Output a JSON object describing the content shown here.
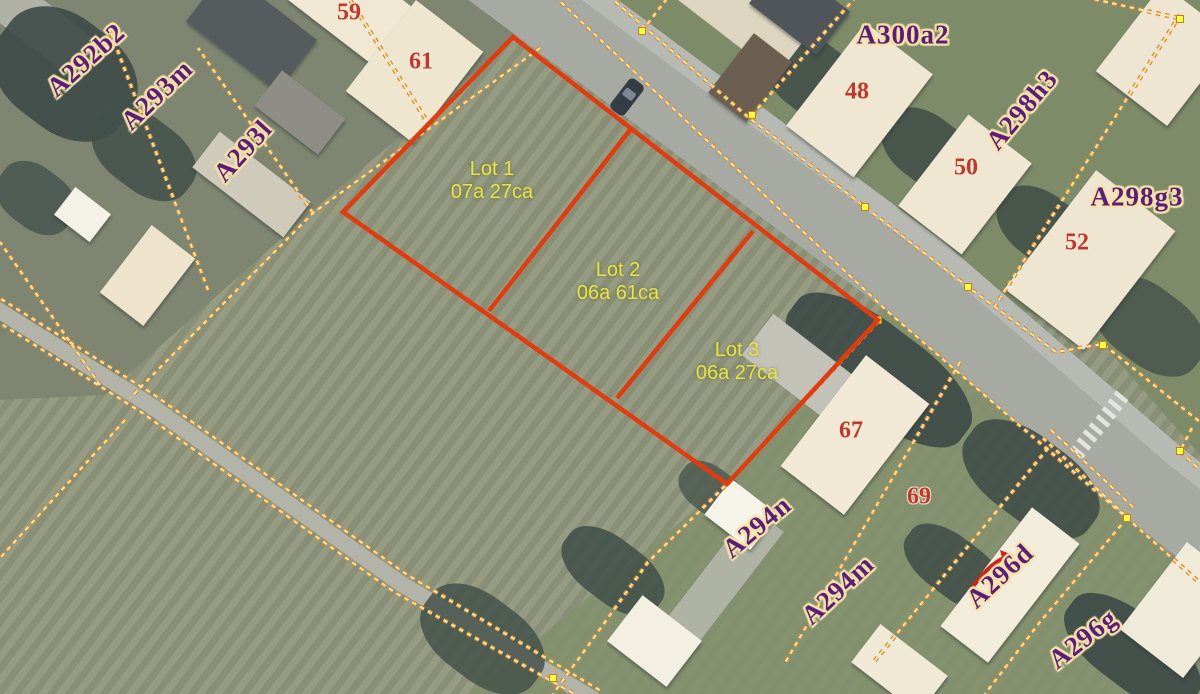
{
  "map": {
    "lot_overlay": {
      "outline_color": "#e23c0e",
      "text_color": "#e9e43e",
      "lots": [
        {
          "label": "Lot 1",
          "area": "07a 27ca"
        },
        {
          "label": "Lot 2",
          "area": "06a 61ca"
        },
        {
          "label": "Lot 3",
          "area": "06a 27ca"
        }
      ]
    },
    "parcels": {
      "text_color": "#5a1d7e",
      "halo_color": "#f5e3a5",
      "labels": [
        "A292b2",
        "A293m",
        "A293l",
        "A300a2",
        "A298h3",
        "A298g3",
        "A294n",
        "A294m",
        "A296d",
        "A296g"
      ]
    },
    "house_numbers": {
      "color": "#bf372e",
      "values": [
        "59",
        "61",
        "48",
        "50",
        "52",
        "67",
        "69"
      ]
    },
    "cadastral": {
      "dash_color": "#d8892f",
      "dash_core_color": "#ffe8a8",
      "vertex_color": "#ffff3d"
    }
  }
}
